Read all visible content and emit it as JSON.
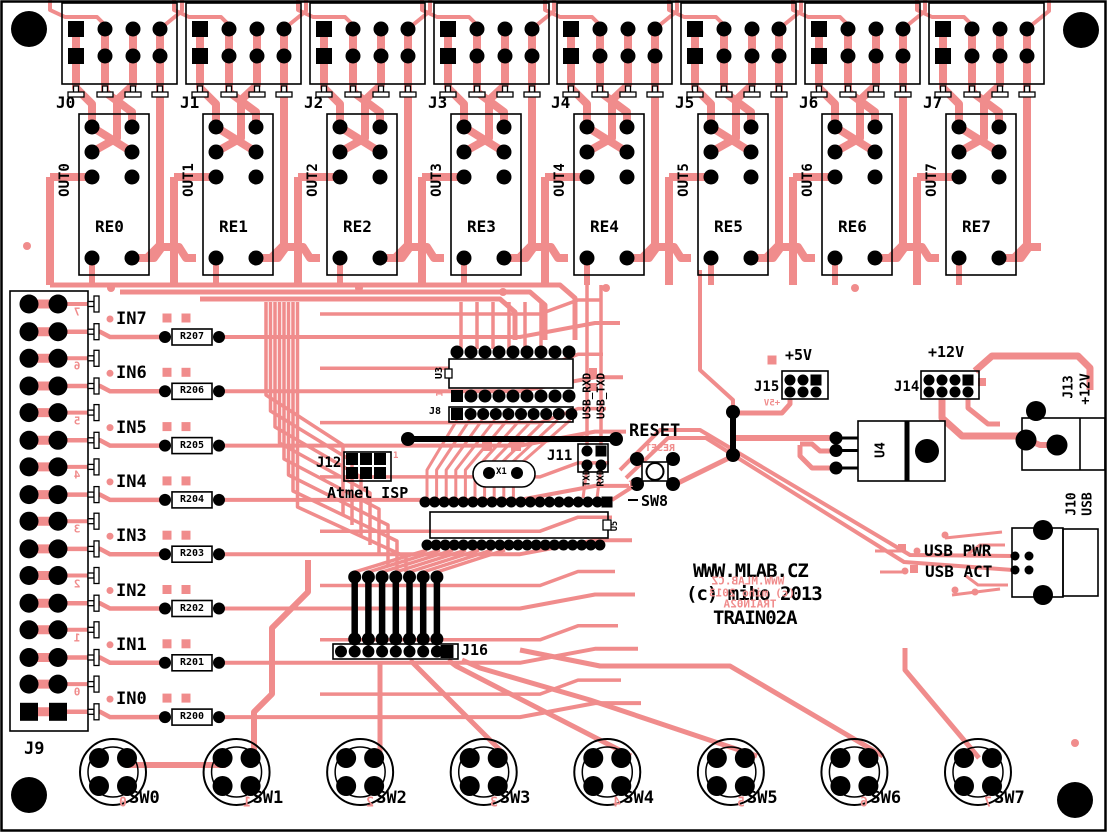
{
  "title_block": {
    "url": "WWW.MLAB.CZ",
    "copyright": "(c) miho 2013",
    "board_name": "TRAIN02A"
  },
  "mirror": {
    "url": "WWW.MLAB.CZ",
    "copyright": "(c) miho 2013",
    "board_name": "TRAIN02A",
    "plus5v": "+5V",
    "reset": "RESET"
  },
  "left_connector": "J9",
  "output_channels": [
    {
      "connector": "J0",
      "out": "OUT0",
      "relay": "RE0"
    },
    {
      "connector": "J1",
      "out": "OUT1",
      "relay": "RE1"
    },
    {
      "connector": "J2",
      "out": "OUT2",
      "relay": "RE2"
    },
    {
      "connector": "J3",
      "out": "OUT3",
      "relay": "RE3"
    },
    {
      "connector": "J4",
      "out": "OUT4",
      "relay": "RE4"
    },
    {
      "connector": "J5",
      "out": "OUT5",
      "relay": "RE5"
    },
    {
      "connector": "J6",
      "out": "OUT6",
      "relay": "RE6"
    },
    {
      "connector": "J7",
      "out": "OUT7",
      "relay": "RE7"
    }
  ],
  "input_channels": [
    {
      "label": "IN7",
      "resistor": "R207",
      "digit": "7"
    },
    {
      "label": "IN6",
      "resistor": "R206",
      "digit": "6"
    },
    {
      "label": "IN5",
      "resistor": "R205",
      "digit": "5"
    },
    {
      "label": "IN4",
      "resistor": "R204",
      "digit": "4"
    },
    {
      "label": "IN3",
      "resistor": "R203",
      "digit": "3"
    },
    {
      "label": "IN2",
      "resistor": "R202",
      "digit": "2"
    },
    {
      "label": "IN1",
      "resistor": "R201",
      "digit": "1"
    },
    {
      "label": "IN0",
      "resistor": "R200",
      "digit": "0"
    }
  ],
  "switches": [
    {
      "label": "SW0",
      "digit": "0"
    },
    {
      "label": "SW1",
      "digit": "1"
    },
    {
      "label": "SW2",
      "digit": "2"
    },
    {
      "label": "SW3",
      "digit": "3"
    },
    {
      "label": "SW4",
      "digit": "4"
    },
    {
      "label": "SW5",
      "digit": "5"
    },
    {
      "label": "SW6",
      "digit": "6"
    },
    {
      "label": "SW7",
      "digit": "7"
    }
  ],
  "ics": {
    "u3": "U3",
    "u4": "U4",
    "u5": "U5"
  },
  "center": {
    "j8": "J8",
    "pin1": "1",
    "j11": "J11",
    "usb_rxd": "USB_RXD",
    "usb_txd": "USB_TXD",
    "txd": "TXD",
    "rxd": "RXD",
    "x1": "X1",
    "j12": "J12",
    "j12_caption": "Atmel ISP",
    "reset": "RESET",
    "sw8": "SW8",
    "j16": "J16"
  },
  "power": {
    "plus5v": "+5V",
    "j15": "J15",
    "plus12v": "+12V",
    "j14": "J14",
    "j13": "J13",
    "j13_voltage": "+12V",
    "j10": "J10",
    "j10_type": "USB",
    "usb_pwr": "USB PWR",
    "usb_act": "USB ACT"
  },
  "colors": {
    "copper": "#F08C8C",
    "silkscreen": "#000000",
    "background": "#FFFFFF"
  }
}
